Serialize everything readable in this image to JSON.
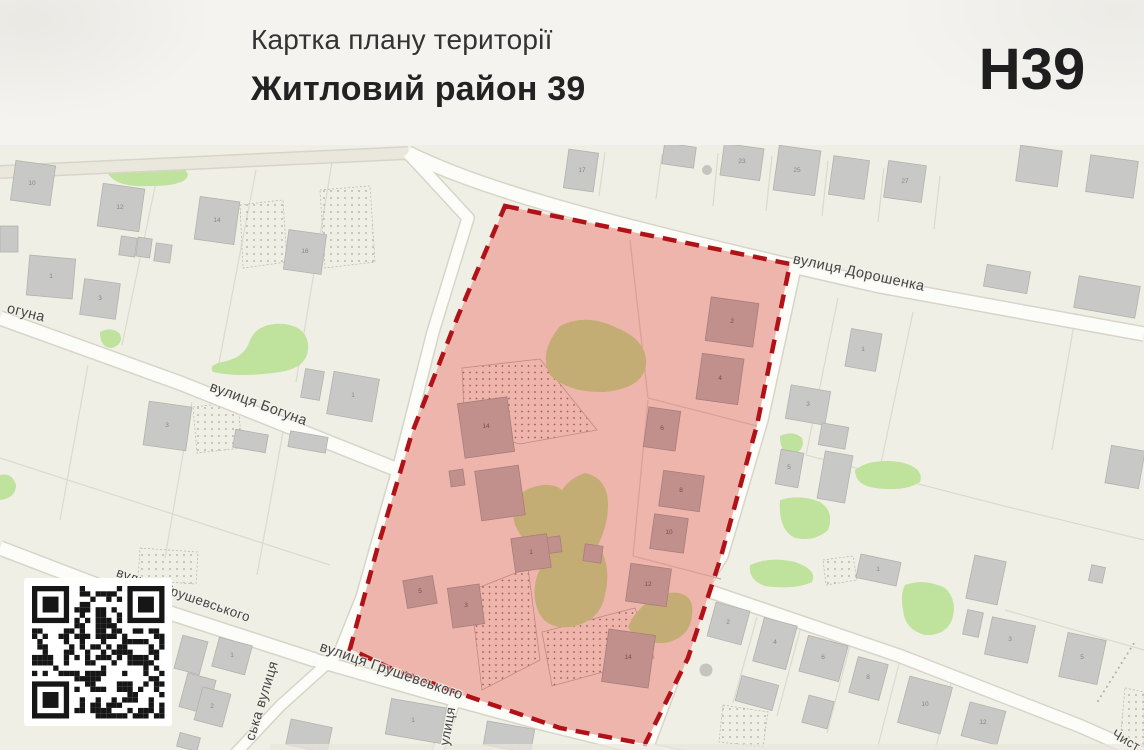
{
  "header": {
    "card_label": "Картка плану території",
    "district_title": "Житловий район 39",
    "zone_code": "Н39"
  },
  "map": {
    "street_labels": [
      {
        "text": "вулиця Дорошенка",
        "x": 858,
        "y": 277,
        "rot": 12,
        "size": 14.5
      },
      {
        "text": "вулиця Богуна",
        "x": 257,
        "y": 408,
        "rot": 20,
        "size": 14.5
      },
      {
        "text": "огуна",
        "x": 25,
        "y": 317,
        "rot": 14,
        "size": 14.5
      },
      {
        "text": "вулиця Грушевського",
        "x": 182,
        "y": 599,
        "rot": 19,
        "size": 13.5
      },
      {
        "text": "вулиця Грушевського",
        "x": 390,
        "y": 675,
        "rot": 19,
        "size": 14.5
      },
      {
        "text": "ська вулиця",
        "x": 266,
        "y": 702,
        "rot": -73,
        "size": 14
      },
      {
        "text": "улиця",
        "x": 452,
        "y": 727,
        "rot": -80,
        "size": 13.5
      },
      {
        "text": "Чист",
        "x": 1124,
        "y": 744,
        "rot": 30,
        "size": 13
      }
    ],
    "building_numbers": {
      "inside": [
        {
          "n": "14",
          "x": 486,
          "y": 428
        },
        {
          "n": "1",
          "x": 531,
          "y": 554
        },
        {
          "n": "3",
          "x": 466,
          "y": 607
        },
        {
          "n": "5",
          "x": 420,
          "y": 593
        },
        {
          "n": "2",
          "x": 732,
          "y": 323
        },
        {
          "n": "4",
          "x": 720,
          "y": 380
        },
        {
          "n": "6",
          "x": 662,
          "y": 430
        },
        {
          "n": "8",
          "x": 681,
          "y": 492
        },
        {
          "n": "10",
          "x": 669,
          "y": 534
        },
        {
          "n": "12",
          "x": 648,
          "y": 586
        },
        {
          "n": "14",
          "x": 628,
          "y": 659
        }
      ],
      "outside": [
        {
          "n": "10",
          "x": 32,
          "y": 185
        },
        {
          "n": "12",
          "x": 120,
          "y": 209
        },
        {
          "n": "14",
          "x": 217,
          "y": 222
        },
        {
          "n": "16",
          "x": 305,
          "y": 253
        },
        {
          "n": "1",
          "x": 51,
          "y": 278
        },
        {
          "n": "3",
          "x": 100,
          "y": 300
        },
        {
          "n": "1",
          "x": 353,
          "y": 397
        },
        {
          "n": "3",
          "x": 167,
          "y": 427
        },
        {
          "n": "17",
          "x": 582,
          "y": 172
        },
        {
          "n": "23",
          "x": 742,
          "y": 163
        },
        {
          "n": "25",
          "x": 797,
          "y": 172
        },
        {
          "n": "27",
          "x": 905,
          "y": 183
        },
        {
          "n": "1",
          "x": 863,
          "y": 351
        },
        {
          "n": "3",
          "x": 808,
          "y": 406
        },
        {
          "n": "5",
          "x": 789,
          "y": 469
        },
        {
          "n": "1",
          "x": 878,
          "y": 571
        },
        {
          "n": "2",
          "x": 728,
          "y": 624
        },
        {
          "n": "4",
          "x": 775,
          "y": 644
        },
        {
          "n": "6",
          "x": 823,
          "y": 659
        },
        {
          "n": "8",
          "x": 868,
          "y": 679
        },
        {
          "n": "10",
          "x": 925,
          "y": 706
        },
        {
          "n": "12",
          "x": 983,
          "y": 724
        },
        {
          "n": "3",
          "x": 1010,
          "y": 641
        },
        {
          "n": "5",
          "x": 1082,
          "y": 659
        },
        {
          "n": "1",
          "x": 232,
          "y": 657
        },
        {
          "n": "2",
          "x": 212,
          "y": 708
        },
        {
          "n": "1",
          "x": 413,
          "y": 722
        }
      ]
    },
    "colors": {
      "zone_fill": "#eeb5ad",
      "zone_border": "#b01218",
      "building_outside": "#c8c8c6",
      "building_inside": "#c2908c",
      "green_area": "#bfe29c",
      "bare_ground": "#c4ad75",
      "map_background": "#f0efe5"
    }
  }
}
